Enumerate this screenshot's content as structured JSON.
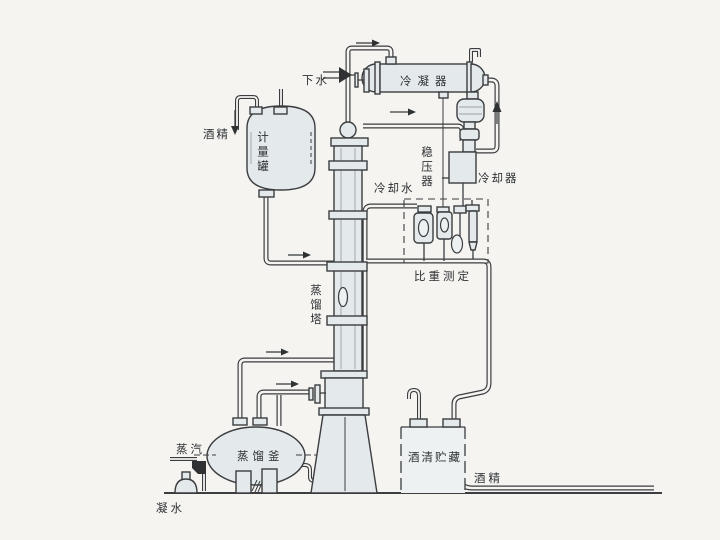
{
  "figure": {
    "labels": {
      "drain_water": "下水",
      "condenser": "冷凝器",
      "alcohol_in": "酒精",
      "measuring_tank": "计量罐",
      "pressure_stabilizer": "稳压器",
      "cooler": "冷却器",
      "cooling_water": "冷却水",
      "density_measurement": "比重测定",
      "distillation_column": "蒸馏塔",
      "distillation_kettle": "蒸馏釜",
      "steam": "蒸汽",
      "condensate_water": "凝水",
      "alcohol_storage": "酒清贮藏",
      "alcohol_out": "酒精"
    },
    "colors": {
      "background": "#f5f4f1",
      "line": "#3b3d40",
      "vessel_fill": "#e4eaec",
      "text": "#2e3033"
    }
  }
}
